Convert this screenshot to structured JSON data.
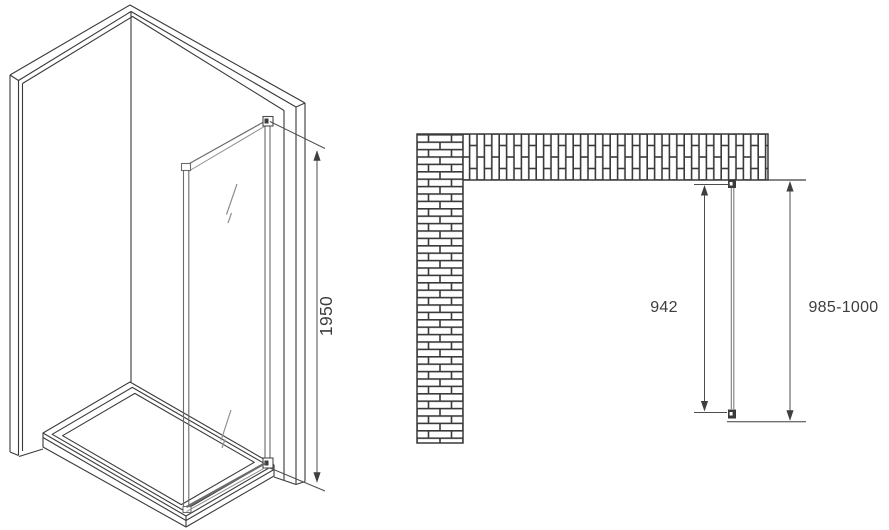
{
  "colors": {
    "background": "#ffffff",
    "line": "#3a3a3a",
    "dimension_line": "#4d4d4d",
    "glass_line": "#8f8f8f",
    "profile_line": "#6b6b6b",
    "text": "#3d3d3d"
  },
  "side_view": {
    "height_dimension": "1950"
  },
  "plan_view": {
    "panel_width_dimension": "942",
    "installation_width_dimension": "985-1000"
  }
}
